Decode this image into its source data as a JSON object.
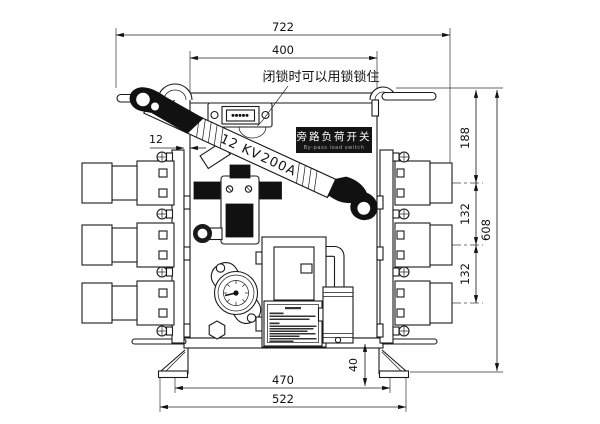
{
  "labels": {
    "lock_note": "闭锁时可以用锁锁住",
    "switch_name_zh": "旁路负荷开关",
    "switch_name_en": "By-pass load switch",
    "rating_voltage": "12 KV",
    "rating_current": "200A"
  },
  "dimensions": {
    "overall_width": "722",
    "top_width": "400",
    "plate_thickness": "12",
    "bushing_top_offset": "188",
    "bushing_spacing_upper": "132",
    "bushing_spacing_lower": "132",
    "overall_height": "608",
    "foot_height": "40",
    "base_width_inner": "470",
    "base_width_outer": "522"
  },
  "colors": {
    "ink": "#1a1a1a",
    "label_bg": "#141414"
  }
}
